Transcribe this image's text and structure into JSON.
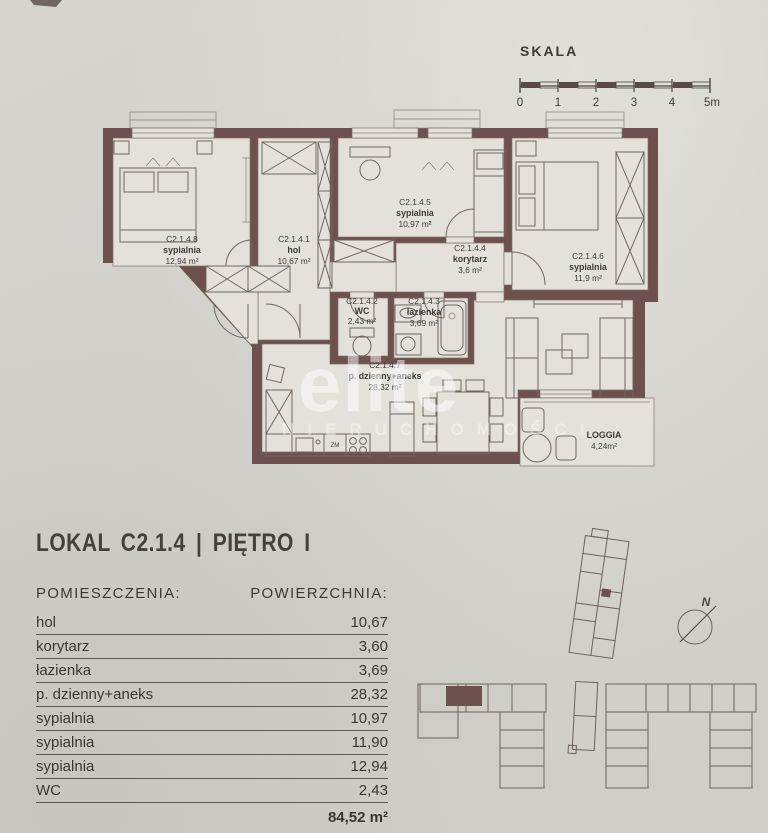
{
  "scale": {
    "title": "SKALA",
    "ticks": [
      "0",
      "1",
      "2",
      "3",
      "4",
      "5m"
    ]
  },
  "plan": {
    "rooms": [
      {
        "id": "C2.1.4.8",
        "name": "sypialnia",
        "area": "12,94 m²"
      },
      {
        "id": "C2.1.4.1",
        "name": "hol",
        "area": "10,67 m²"
      },
      {
        "id": "C2.1.4.5",
        "name": "sypialnia",
        "area": "10,97 m²"
      },
      {
        "id": "C2.1.4.4",
        "name": "korytarz",
        "area": "3,6 m²"
      },
      {
        "id": "C2.1.4.6",
        "name": "sypialnia",
        "area": "11,9 m²"
      },
      {
        "id": "C2.1.4.2",
        "name": "WC",
        "area": "2,43 m²"
      },
      {
        "id": "C2.1.4.3",
        "name": "łazienka",
        "area": "3,69 m²"
      },
      {
        "id": "C2.1.4.7",
        "name": "p. dzienny+aneks",
        "area": "28,32 m²"
      }
    ],
    "loggia": {
      "name": "LOGGIA",
      "area": "4,24m²"
    },
    "labels": {
      "dishwasher": "ZM"
    }
  },
  "header": {
    "title": "LOKAL C2.1.4 | PIĘTRO I"
  },
  "watermark": {
    "line1": "elite",
    "line2": "NIERUCHOMOŚCI"
  },
  "legend_table": {
    "header_name": "POMIESZCZENIA:",
    "header_area": "POWIERZCHNIA:",
    "rows": [
      {
        "name": "hol",
        "area": "10,67"
      },
      {
        "name": "korytarz",
        "area": "3,60"
      },
      {
        "name": "łazienka",
        "area": "3,69"
      },
      {
        "name": "p. dzienny+aneks",
        "area": "28,32"
      },
      {
        "name": "sypialnia",
        "area": "10,97"
      },
      {
        "name": "sypialnia",
        "area": "11,90"
      },
      {
        "name": "sypialnia",
        "area": "12,94"
      },
      {
        "name": "WC",
        "area": "2,43"
      }
    ],
    "total": "84,52 m²"
  },
  "compass": {
    "label": "N"
  },
  "colors": {
    "wall": "#6e504e",
    "floor": "#e4e1db",
    "paper": "#d3d1cc",
    "line": "#6f6661"
  }
}
